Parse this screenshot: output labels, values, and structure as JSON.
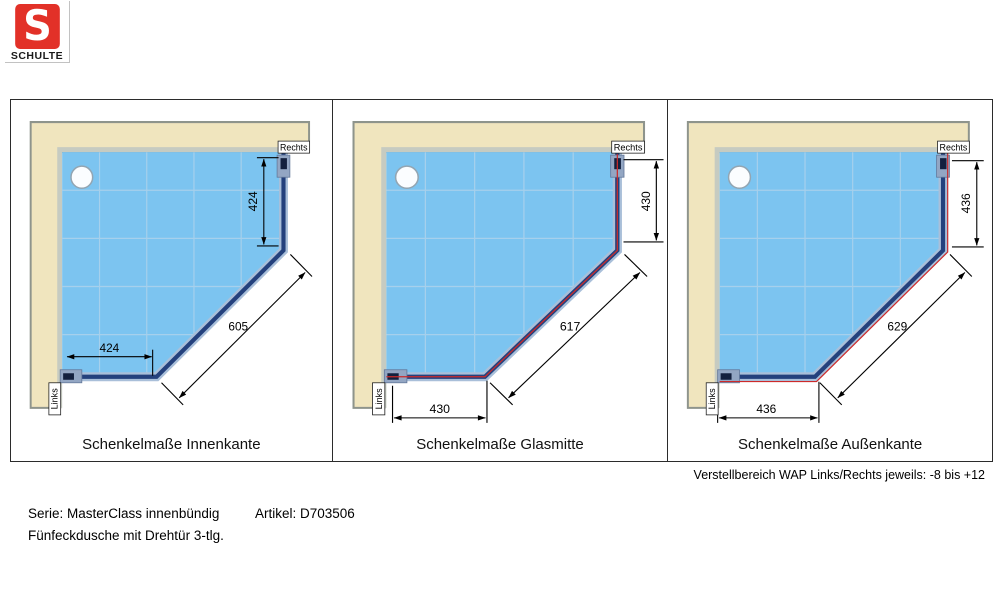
{
  "header": {
    "logo_letter": "S",
    "logo_text": "SCHULTE"
  },
  "panels": [
    {
      "id": "innenkante",
      "caption": "Schenkelmaße Innenkante",
      "label_right": "Rechts",
      "label_left": "Links",
      "dim_right_leg": "424",
      "dim_bottom_leg": "424",
      "dim_diagonal": "605"
    },
    {
      "id": "glasmitte",
      "caption": "Schenkelmaße Glasmitte",
      "label_right": "Rechts",
      "label_left": "Links",
      "dim_right_leg": "430",
      "dim_bottom_leg": "430",
      "dim_diagonal": "617"
    },
    {
      "id": "aussenkante",
      "caption": "Schenkelmaße Außenkante",
      "label_right": "Rechts",
      "label_left": "Links",
      "dim_right_leg": "436",
      "dim_bottom_leg": "436",
      "dim_diagonal": "629"
    }
  ],
  "footer": {
    "adjustment_note": "Verstellbereich WAP Links/Rechts jeweils: -8 bis +12",
    "series": "Serie: MasterClass innenbündig",
    "article": "Artikel: D703506",
    "product": "Fünfeckdusche mit Drehtür 3-tlg."
  },
  "colors": {
    "logo_red": "#e23128",
    "wall_beige": "#f0e5be",
    "tray_lip_gray": "#c6cbc1",
    "floor_blue": "#7cc4f0",
    "floor_grid": "#a6d0ec",
    "glass_casing": "#a9bfd9",
    "glass_navy": "#24417d",
    "profile_blue_gray": "#93a6c3",
    "marking_red": "#cc2a2a",
    "dimension_black": "#000000"
  }
}
